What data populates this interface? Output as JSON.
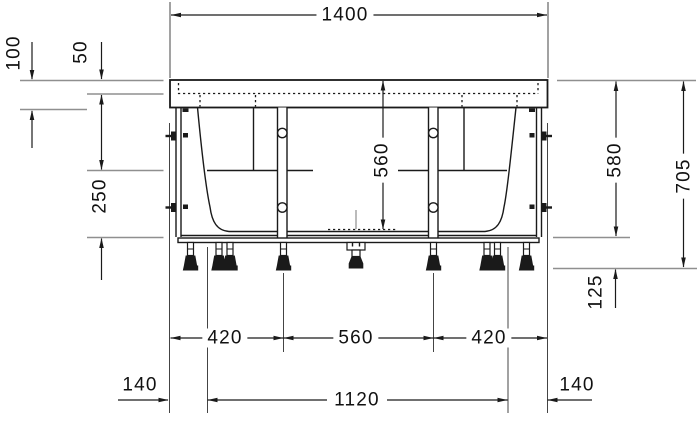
{
  "drawing": {
    "type": "bathtub installation drawing, front elevation",
    "units": "mm"
  },
  "dimensions": {
    "overall_width": "1400",
    "rim_drop": "100",
    "rim_edge": "50",
    "apron_height": "250",
    "inner_depth": "560",
    "rim_height": "580",
    "overall_height": "705",
    "feet_height": "125",
    "foot_span_left": "420",
    "foot_span_center": "560",
    "foot_span_right": "420",
    "offset_left": "140",
    "frame_span": "1120",
    "offset_right": "140"
  },
  "colors": {
    "line": "#1a1a1a",
    "reference_line": "#8f8f8f",
    "background": "#ffffff"
  }
}
